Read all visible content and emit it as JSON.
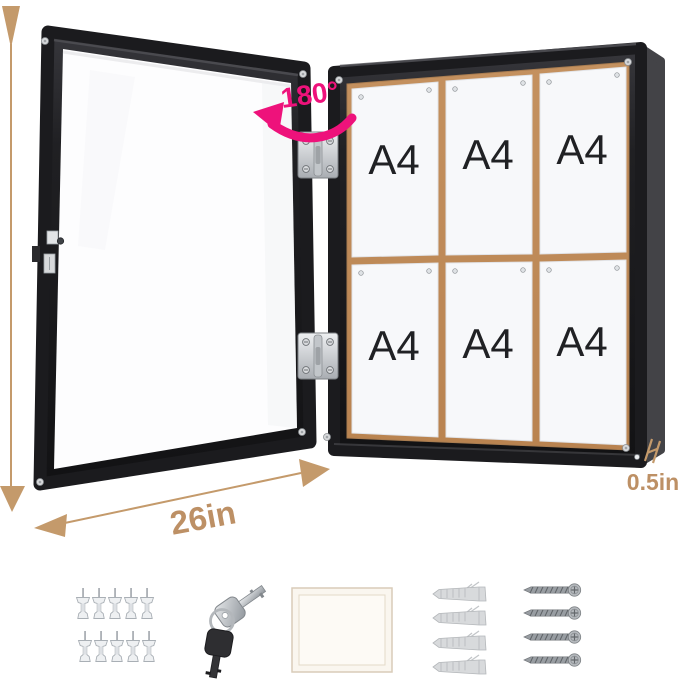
{
  "title": "Lockable enclosed notice board diagram, door open with six pinned sheets and mounting hardware",
  "colors": {
    "background": "#ffffff",
    "dimension": "#bd9065",
    "dimension_arrow": "#c49a6b",
    "accent_pink": "#ee127b",
    "frame_black": "#1b1b1e",
    "board_side": "#434347",
    "cork": "#c08d60",
    "paper": "#f7f8fa",
    "metal": "#d6d8da",
    "a4_text": "#202124"
  },
  "annotations": {
    "height_label": "28in",
    "width_label": "26in",
    "depth_label": "0.5in",
    "rotation_label": "180°"
  },
  "board": {
    "rows": 2,
    "columns": 3,
    "papers": [
      {
        "label": "A4"
      },
      {
        "label": "A4"
      },
      {
        "label": "A4"
      },
      {
        "label": "A4"
      },
      {
        "label": "A4"
      },
      {
        "label": "A4"
      }
    ]
  },
  "door": {
    "hinges": 2,
    "has_lock": true
  },
  "accessories": [
    {
      "name": "push-pins",
      "count": 10
    },
    {
      "name": "keys",
      "count": 2
    },
    {
      "name": "mounting-card",
      "count": 1
    },
    {
      "name": "wall-anchors",
      "count": 4
    },
    {
      "name": "screws",
      "count": 4
    }
  ]
}
